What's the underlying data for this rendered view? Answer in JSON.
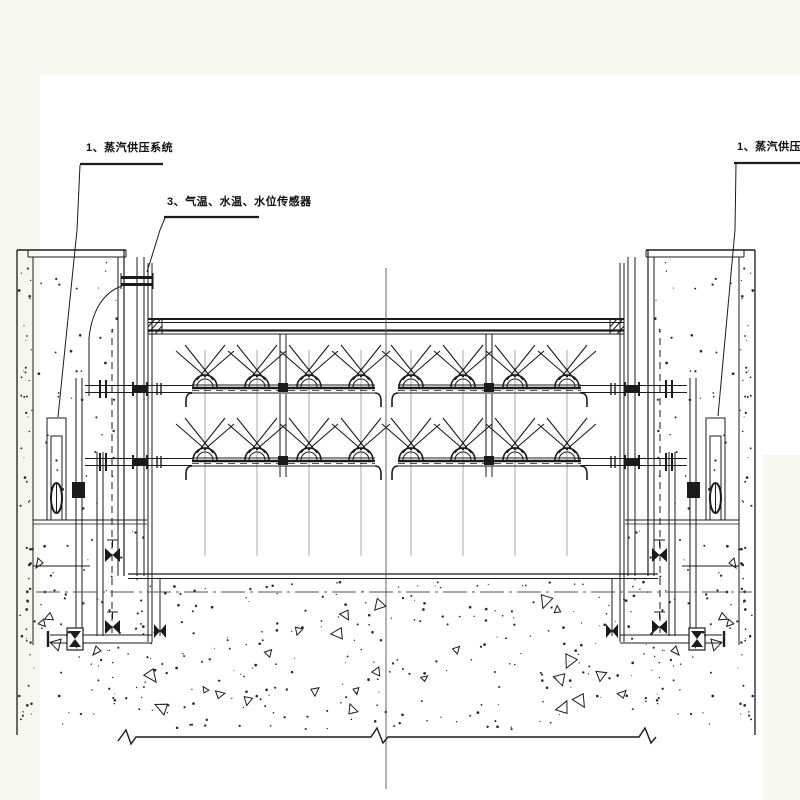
{
  "page": {
    "background_color": "#f6f8ef",
    "canvas_color": "#ffffff"
  },
  "drawing": {
    "line_color": "#1b1b1b",
    "centerline_color": "#555555",
    "annotations": [
      {
        "id": "steam-supply-left",
        "label": "1、蒸汽供压系统"
      },
      {
        "id": "sensors",
        "label": "3、气温、水温、水位传感器"
      },
      {
        "id": "steam-supply-right",
        "label": "1、蒸汽供压系统"
      }
    ],
    "heating": {
      "nozzle_rows": 2,
      "groups_per_row": 2,
      "nozzles_per_group": 4
    }
  }
}
